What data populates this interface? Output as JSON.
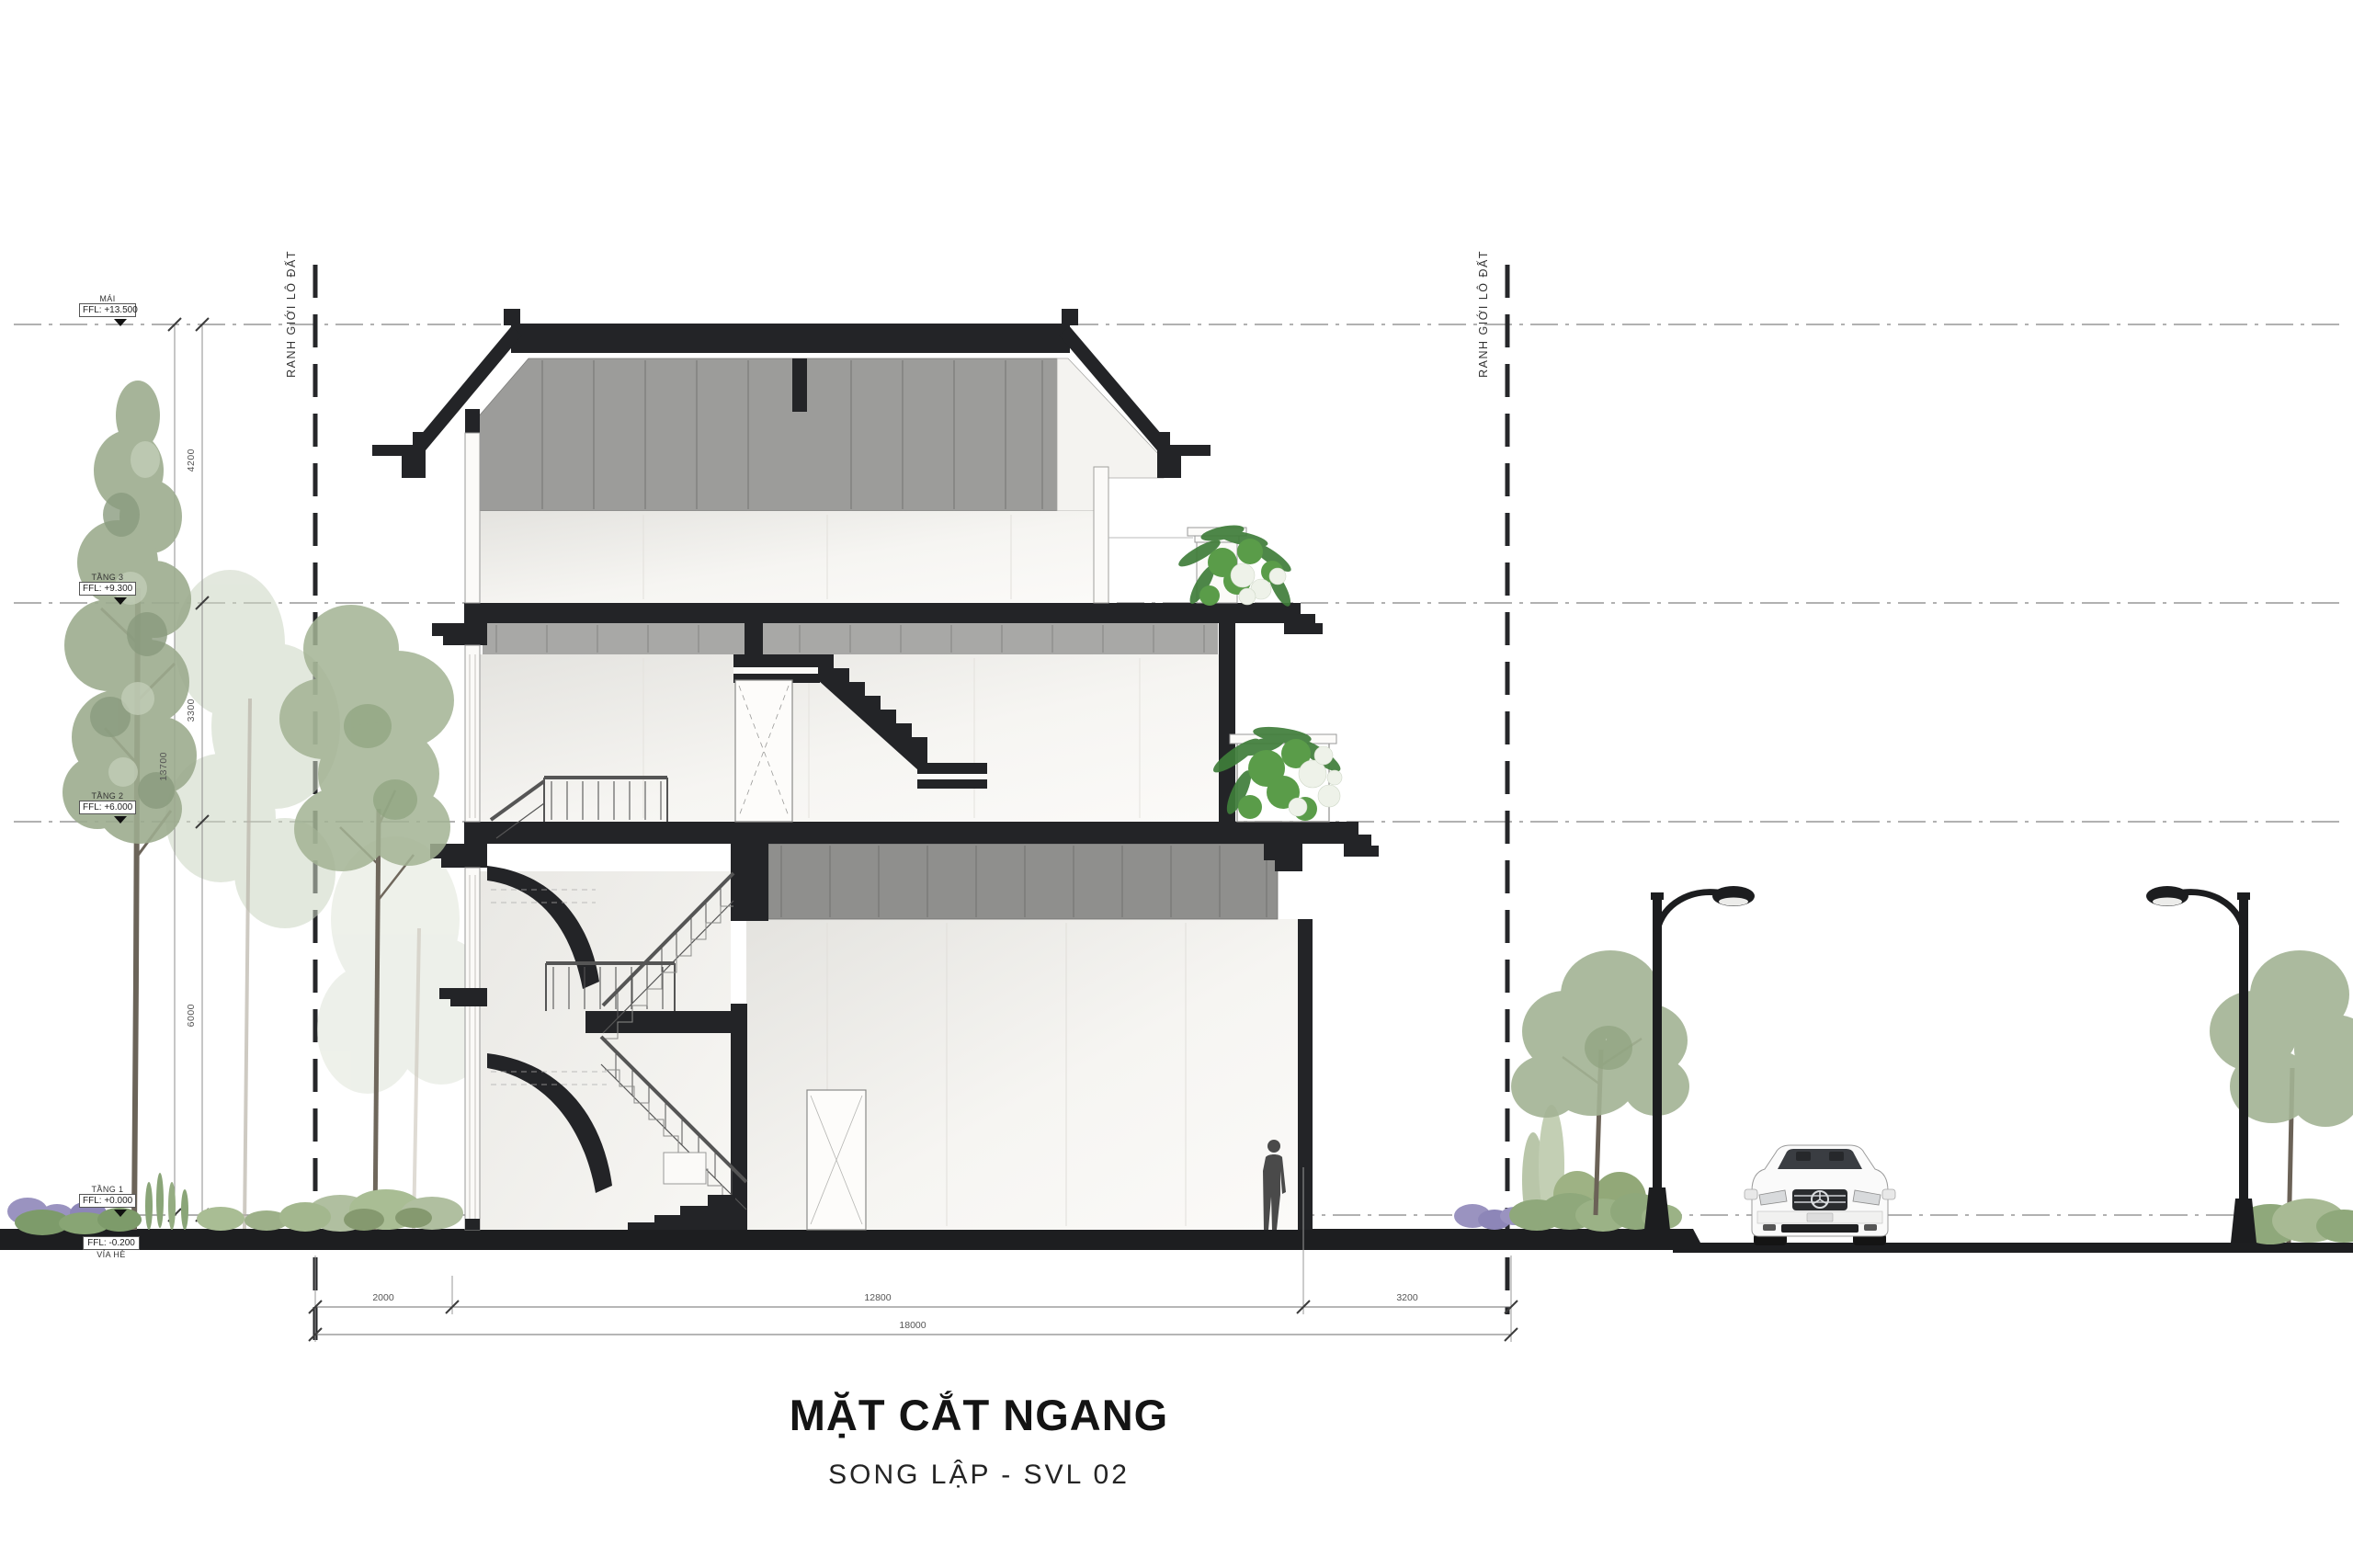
{
  "drawing": {
    "title": "MẶT CẮT NGANG",
    "subtitle": "SONG LẬP - SVL 02",
    "boundary_label": "RANH GIỚI LÔ ĐẤT",
    "levels": [
      {
        "name": "MÁI",
        "ffl": "FFL: +13.500"
      },
      {
        "name": "TẦNG 3",
        "ffl": "FFL: +9.300"
      },
      {
        "name": "TẦNG 2",
        "ffl": "FFL: +6.000"
      },
      {
        "name": "TẦNG 1",
        "ffl": "FFL: +0.000"
      },
      {
        "name": "VỈA HÈ",
        "ffl": "FFL: -0.200"
      }
    ],
    "dims_vertical": {
      "overall": "13700",
      "f3": "4200",
      "f2": "3300",
      "f1": "6000"
    },
    "dims_horizontal": {
      "left": "2000",
      "center": "12800",
      "right": "3200",
      "overall": "18000"
    },
    "colors": {
      "cut_black": "#232427",
      "attic_gray": "#9c9c9a",
      "roof_gray": "#8f8f8d",
      "interior_light": "#f2f1ed",
      "foliage_green": "#a3b394",
      "planter_green": "#3f7d3a",
      "flower_white": "#eef2e9",
      "lavender": "#9a93c0",
      "ground_black": "#1d1e20"
    }
  }
}
